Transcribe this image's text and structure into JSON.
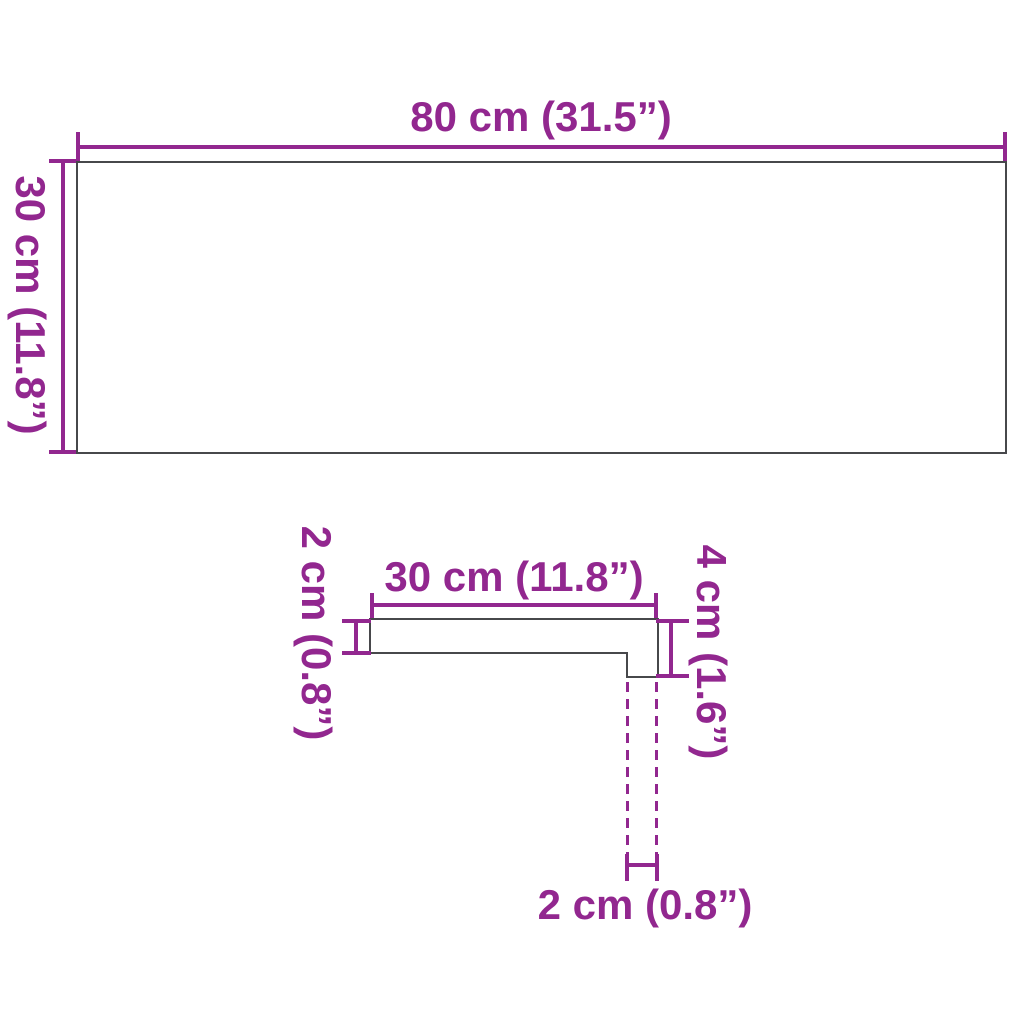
{
  "diagram": {
    "accent_color": "#92278F",
    "outline_color": "#47484B",
    "top_view": {
      "width_label": "80 cm (31.5”)",
      "depth_label": "30 cm (11.8”)"
    },
    "profile_view": {
      "width_label": "30 cm (11.8”)",
      "thickness_label": "2 cm (0.8”)",
      "nose_height_label": "4 cm (1.6”)",
      "nose_width_label": "2 cm (0.8”)"
    }
  }
}
